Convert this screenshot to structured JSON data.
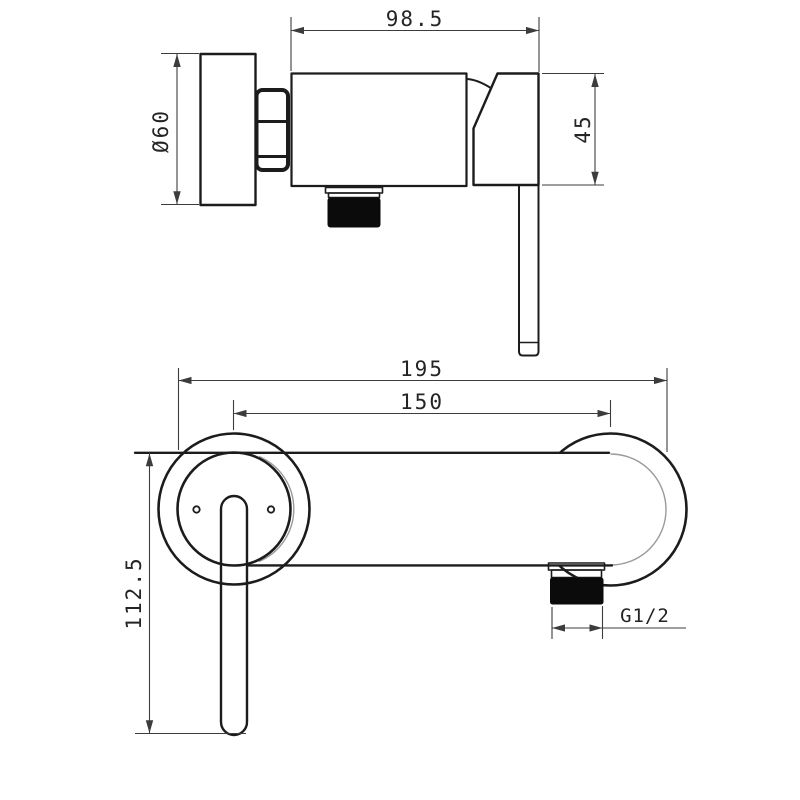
{
  "colors": {
    "background": "#ffffff",
    "outline": "#1c1c1c",
    "dimension_line": "#3c3c3c",
    "tangent_line": "#9a9a9a",
    "solid_fill": "#0b0b0b",
    "text": "#242424"
  },
  "side_view": {
    "dimensions": {
      "depth": "98.5",
      "body_height": "45",
      "flange_diameter": "Ø60"
    }
  },
  "front_view": {
    "dimensions": {
      "overall_width": "195",
      "centres": "150",
      "overall_height": "112.5",
      "outlet_thread": "G1/2"
    }
  }
}
